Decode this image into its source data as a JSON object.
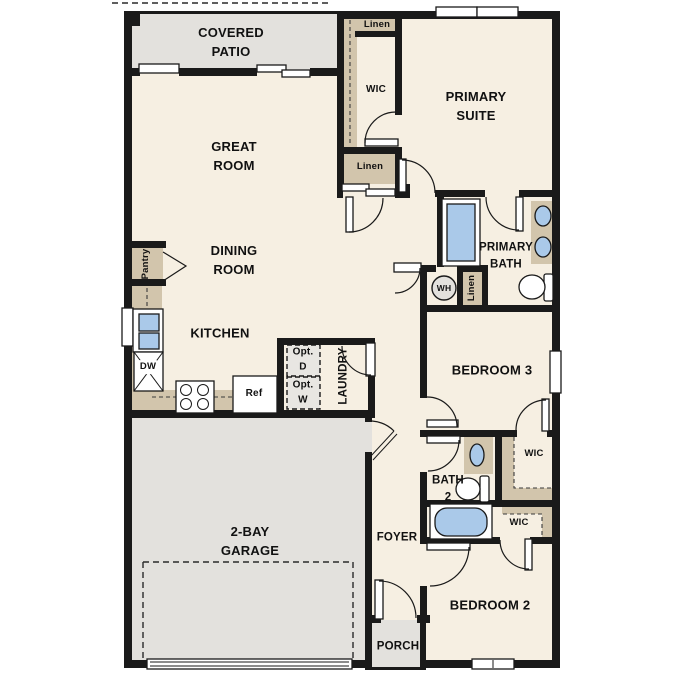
{
  "labels": {
    "covered_patio": "COVERED\nPATIO",
    "great_room": "GREAT\nROOM",
    "dining_room": "DINING\nROOM",
    "kitchen": "KITCHEN",
    "pantry": "Pantry",
    "laundry": "LAUNDRY",
    "garage": "2-BAY\nGARAGE",
    "foyer": "FOYER",
    "porch": "PORCH",
    "primary_suite": "PRIMARY\nSUITE",
    "primary_bath": "PRIMARY\nBATH",
    "bedroom3": "BEDROOM 3",
    "bedroom2": "BEDROOM 2",
    "bath2": "BATH\n2",
    "wic_primary": "WIC",
    "wic_bedroom3": "WIC",
    "wic_bedroom2": "WIC",
    "linen_top": "Linen",
    "linen_mid": "Linen",
    "linen_bath": "Linen",
    "wh": "WH",
    "dw": "DW",
    "ref": "Ref",
    "opt_d": "Opt.\nD",
    "opt_w": "Opt.\nW"
  },
  "colors": {
    "wall": "#1a1a1a",
    "room": "#f6efe2",
    "outdoor": "#e3e1dd",
    "closet": "#d2c5ac",
    "fixture_blue": "#aac9e9",
    "optional": "#e8e6e2",
    "fixture_white": "#ffffff"
  }
}
